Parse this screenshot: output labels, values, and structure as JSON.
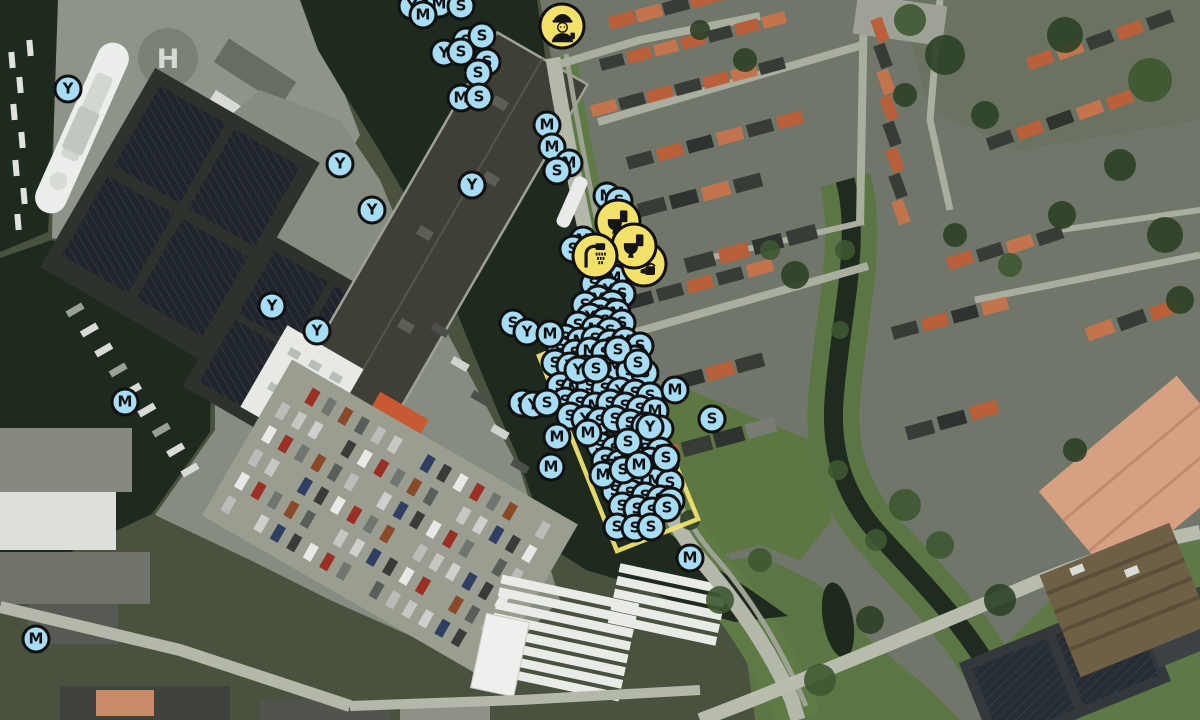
{
  "map": {
    "background_label": {
      "helipad": "H"
    },
    "colors": {
      "berth_marker_fill": "#a6dcf4",
      "service_marker_fill": "#f4e169",
      "marker_border": "#101010",
      "zone_stroke": "#f0e26e"
    },
    "zone": {
      "points": [
        [
          539,
          356
        ],
        [
          618,
          323
        ],
        [
          698,
          519
        ],
        [
          617,
          551
        ]
      ]
    },
    "berth_markers": [
      [
        68,
        89,
        "Y"
      ],
      [
        412,
        6,
        "Y"
      ],
      [
        439,
        4,
        "M"
      ],
      [
        423,
        15,
        "M"
      ],
      [
        461,
        6,
        "S"
      ],
      [
        466,
        41,
        "S"
      ],
      [
        482,
        36,
        "S"
      ],
      [
        487,
        62,
        "S"
      ],
      [
        444,
        53,
        "Y"
      ],
      [
        461,
        52,
        "S"
      ],
      [
        478,
        73,
        "S"
      ],
      [
        461,
        98,
        "M"
      ],
      [
        479,
        97,
        "S"
      ],
      [
        340,
        164,
        "Y"
      ],
      [
        472,
        185,
        "Y"
      ],
      [
        372,
        210,
        "Y"
      ],
      [
        272,
        306,
        "Y"
      ],
      [
        317,
        331,
        "Y"
      ],
      [
        125,
        402,
        "M"
      ],
      [
        36,
        639,
        "M"
      ],
      [
        547,
        125,
        "M"
      ],
      [
        552,
        147,
        "M"
      ],
      [
        569,
        163,
        "M"
      ],
      [
        557,
        171,
        "S"
      ],
      [
        690,
        558,
        "M"
      ],
      [
        712,
        419,
        "S"
      ],
      [
        607,
        196,
        "M"
      ],
      [
        619,
        201,
        "S"
      ],
      [
        583,
        240,
        "M"
      ],
      [
        573,
        249,
        "S"
      ],
      [
        587,
        258,
        "S"
      ],
      [
        601,
        272,
        "S"
      ],
      [
        614,
        278,
        "M"
      ],
      [
        594,
        284,
        "S"
      ],
      [
        608,
        290,
        "Y"
      ],
      [
        622,
        294,
        "S"
      ],
      [
        598,
        299,
        "M"
      ],
      [
        585,
        305,
        "S"
      ],
      [
        612,
        304,
        "S"
      ],
      [
        600,
        311,
        "S"
      ],
      [
        617,
        313,
        "M"
      ],
      [
        590,
        317,
        "Y"
      ],
      [
        605,
        321,
        "S"
      ],
      [
        622,
        323,
        "S"
      ],
      [
        578,
        325,
        "S"
      ],
      [
        595,
        329,
        "M"
      ],
      [
        610,
        331,
        "S"
      ],
      [
        565,
        338,
        "S"
      ],
      [
        580,
        341,
        "M"
      ],
      [
        595,
        339,
        "S"
      ],
      [
        610,
        343,
        "S"
      ],
      [
        625,
        341,
        "Y"
      ],
      [
        640,
        346,
        "S"
      ],
      [
        560,
        350,
        "S"
      ],
      [
        575,
        353,
        "S"
      ],
      [
        590,
        351,
        "M"
      ],
      [
        605,
        353,
        "S"
      ],
      [
        620,
        356,
        "S"
      ],
      [
        635,
        359,
        "S"
      ],
      [
        555,
        363,
        "S"
      ],
      [
        570,
        366,
        "Y"
      ],
      [
        585,
        369,
        "S"
      ],
      [
        600,
        369,
        "S"
      ],
      [
        615,
        367,
        "M"
      ],
      [
        630,
        371,
        "S"
      ],
      [
        645,
        373,
        "S"
      ],
      [
        560,
        386,
        "S"
      ],
      [
        575,
        389,
        "M"
      ],
      [
        590,
        386,
        "S"
      ],
      [
        605,
        389,
        "S"
      ],
      [
        620,
        391,
        "Y"
      ],
      [
        635,
        393,
        "S"
      ],
      [
        650,
        396,
        "S"
      ],
      [
        565,
        401,
        "S"
      ],
      [
        580,
        403,
        "S"
      ],
      [
        595,
        406,
        "M"
      ],
      [
        610,
        403,
        "S"
      ],
      [
        625,
        406,
        "S"
      ],
      [
        640,
        409,
        "S"
      ],
      [
        655,
        411,
        "M"
      ],
      [
        570,
        416,
        "S"
      ],
      [
        585,
        419,
        "Y"
      ],
      [
        600,
        421,
        "S"
      ],
      [
        615,
        419,
        "S"
      ],
      [
        630,
        423,
        "S"
      ],
      [
        645,
        426,
        "S"
      ],
      [
        660,
        429,
        "S"
      ],
      [
        600,
        446,
        "S"
      ],
      [
        615,
        449,
        "S"
      ],
      [
        630,
        446,
        "M"
      ],
      [
        645,
        449,
        "S"
      ],
      [
        660,
        451,
        "S"
      ],
      [
        605,
        461,
        "S"
      ],
      [
        620,
        463,
        "M"
      ],
      [
        635,
        459,
        "S"
      ],
      [
        650,
        461,
        "S"
      ],
      [
        665,
        463,
        "S"
      ],
      [
        610,
        473,
        "S"
      ],
      [
        625,
        476,
        "S"
      ],
      [
        640,
        479,
        "S"
      ],
      [
        655,
        481,
        "M"
      ],
      [
        670,
        483,
        "S"
      ],
      [
        615,
        491,
        "S"
      ],
      [
        630,
        493,
        "S"
      ],
      [
        645,
        496,
        "S"
      ],
      [
        660,
        499,
        "S"
      ],
      [
        671,
        501,
        "S"
      ],
      [
        622,
        506,
        "S"
      ],
      [
        637,
        509,
        "S"
      ],
      [
        652,
        511,
        "S"
      ],
      [
        513,
        323,
        "S"
      ],
      [
        527,
        332,
        "Y"
      ],
      [
        550,
        334,
        "M"
      ],
      [
        618,
        350,
        "S"
      ],
      [
        638,
        363,
        "S"
      ],
      [
        578,
        370,
        "Y"
      ],
      [
        596,
        369,
        "S"
      ],
      [
        522,
        403,
        "S"
      ],
      [
        533,
        405,
        "Y"
      ],
      [
        547,
        403,
        "S"
      ],
      [
        675,
        390,
        "M"
      ],
      [
        650,
        427,
        "Y"
      ],
      [
        628,
        442,
        "S"
      ],
      [
        588,
        433,
        "M"
      ],
      [
        557,
        437,
        "M"
      ],
      [
        551,
        467,
        "M"
      ],
      [
        603,
        475,
        "M"
      ],
      [
        623,
        470,
        "S"
      ],
      [
        639,
        465,
        "M"
      ],
      [
        666,
        458,
        "S"
      ],
      [
        667,
        508,
        "S"
      ],
      [
        617,
        527,
        "S"
      ],
      [
        635,
        528,
        "S"
      ],
      [
        651,
        527,
        "S"
      ]
    ],
    "service_markers": [
      [
        618,
        222,
        "toilet-icon"
      ],
      [
        644,
        264,
        "waste-icon"
      ],
      [
        634,
        246,
        "toilet-icon"
      ],
      [
        595,
        256,
        "shower-icon"
      ],
      [
        562,
        26,
        "harbourmaster-icon"
      ]
    ]
  }
}
